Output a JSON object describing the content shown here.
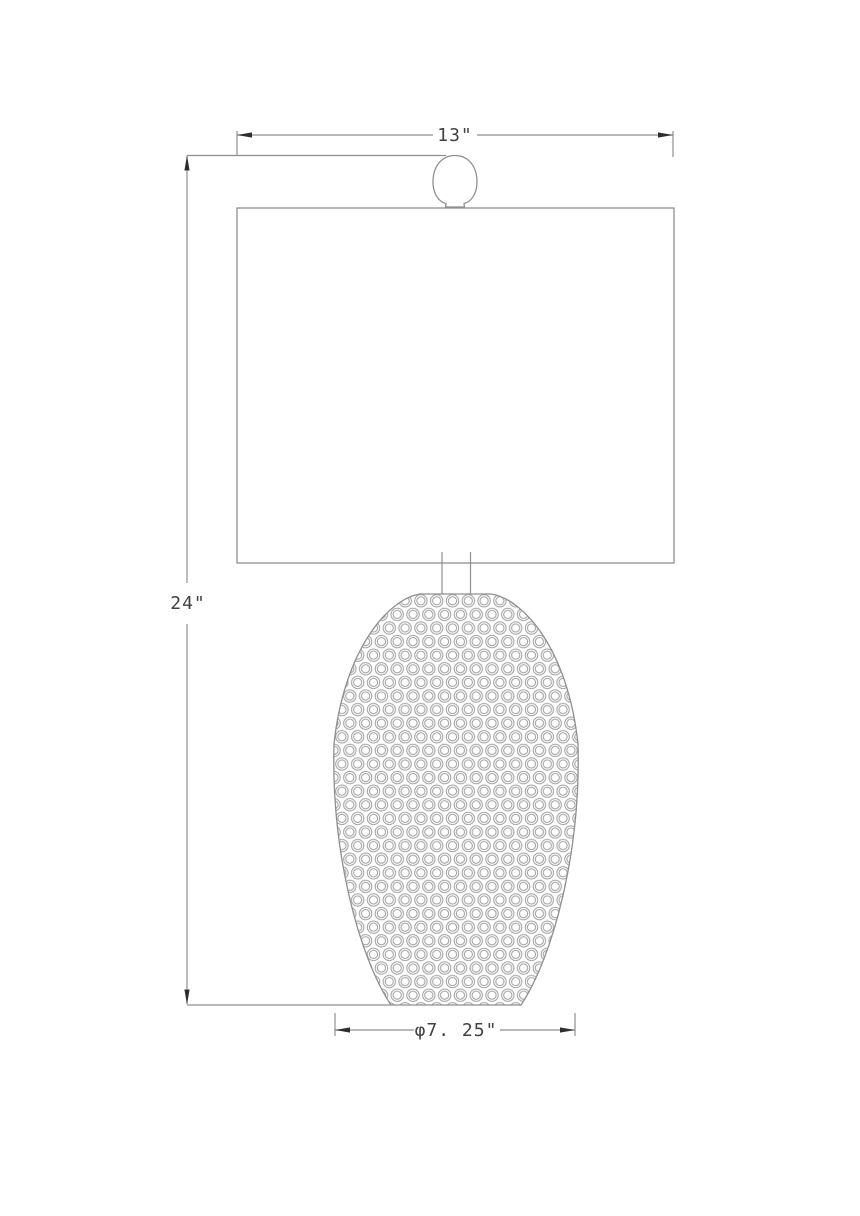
{
  "drawing": {
    "type": "table-lamp dimension drawing",
    "dimensions": {
      "shade_width_label": "13\"",
      "overall_height_label": "24\"",
      "body_diameter_label": "φ7. 25\""
    }
  },
  "colors": {
    "background": "#ffffff",
    "line": "#8f8f8f",
    "ring": "#a0a0a0",
    "arrow": "#2e2e2e",
    "text": "#414141"
  }
}
